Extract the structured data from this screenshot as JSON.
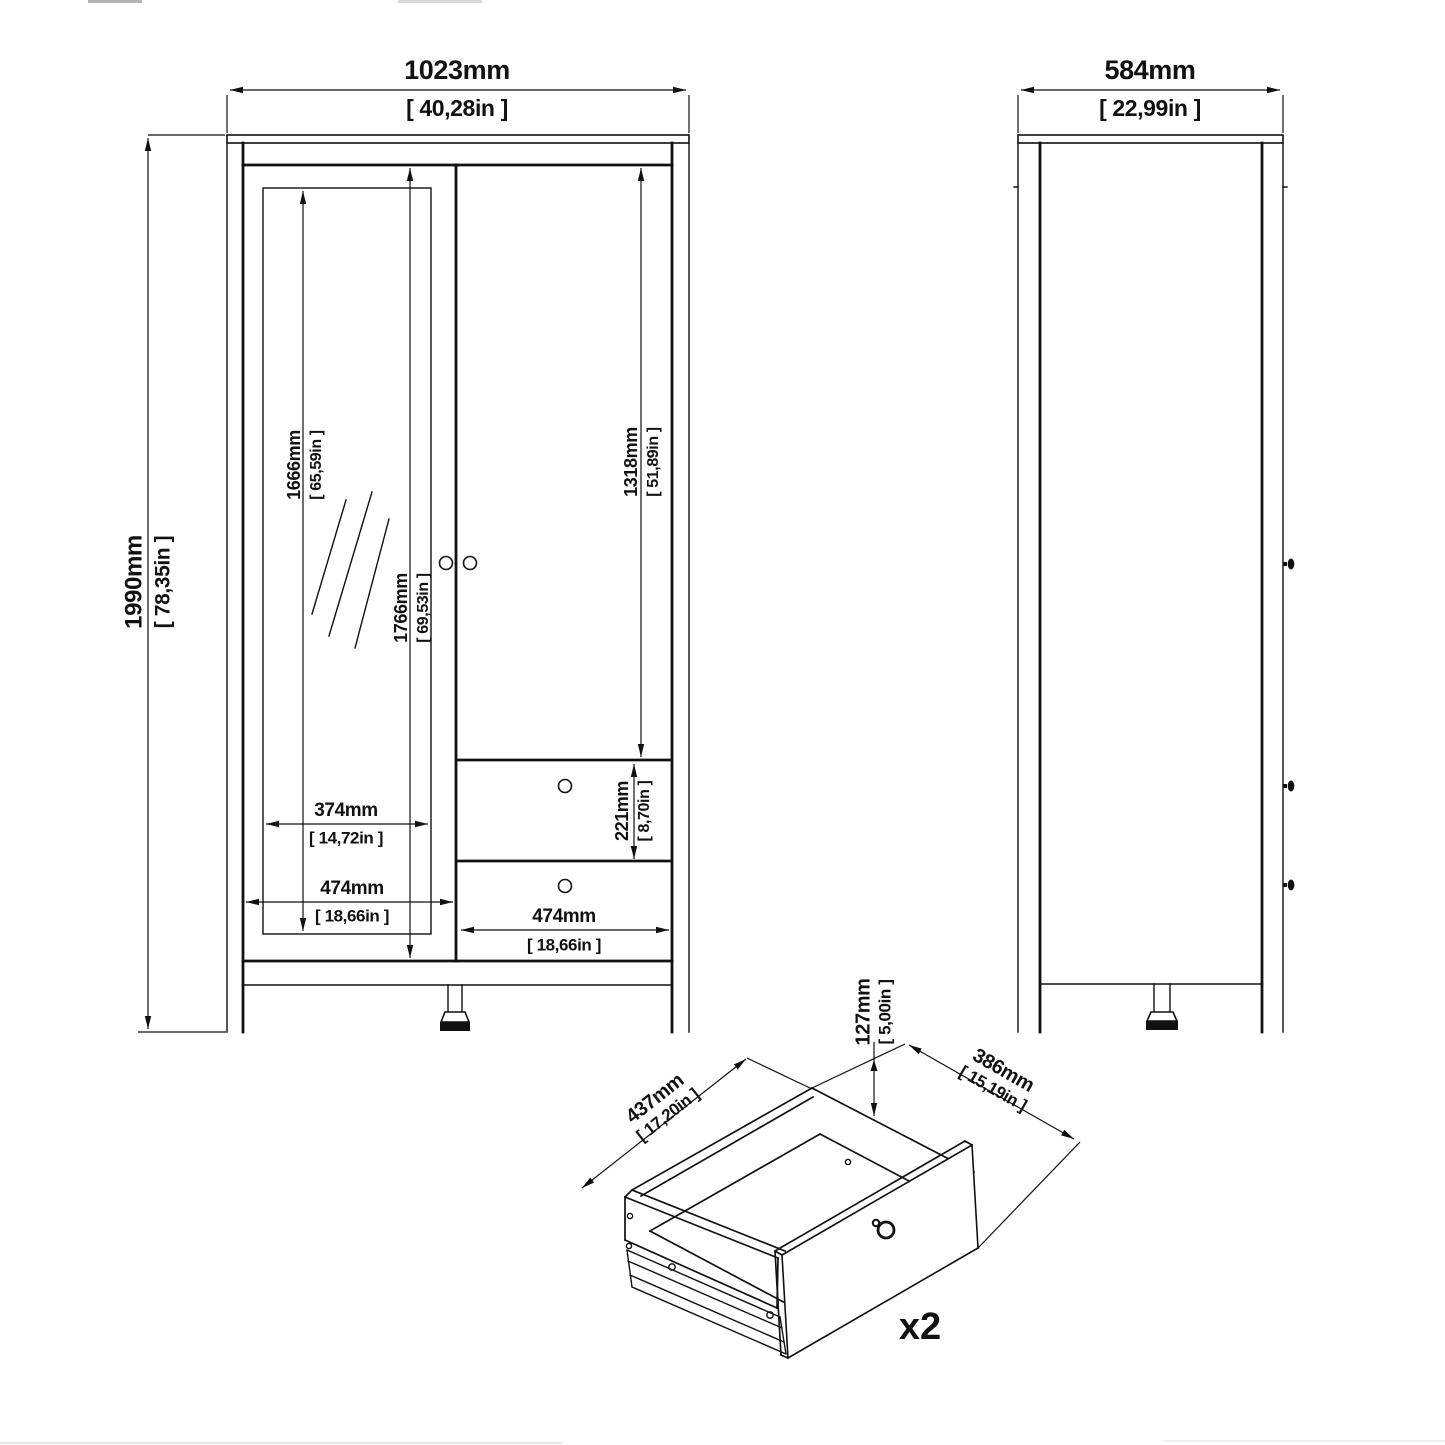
{
  "front_view": {
    "width_mm": "1023mm",
    "width_in": "[ 40,28in ]",
    "height_mm": "1990mm",
    "height_in": "[ 78,35in ]",
    "mirror_height_mm": "1666mm",
    "mirror_height_in": "[ 65,59in ]",
    "door_height_mm": "1766mm",
    "door_height_in": "[ 69,53in ]",
    "right_door_mm": "1318mm",
    "right_door_in": "[ 51,89in ]",
    "mirror_width_mm": "374mm",
    "mirror_width_in": "[ 14,72in ]",
    "door_width_mm": "474mm",
    "door_width_in": "[ 18,66in ]",
    "drawer_height_mm": "221mm",
    "drawer_height_in": "[ 8,70in ]",
    "drawer_width_mm": "474mm",
    "drawer_width_in": "[ 18,66in ]"
  },
  "side_view": {
    "depth_mm": "584mm",
    "depth_in": "[ 22,99in ]"
  },
  "drawer_detail": {
    "depth_mm": "437mm",
    "depth_in": "[ 17,20in ]",
    "width_mm": "386mm",
    "width_in": "[ 15,19in ]",
    "height_mm": "127mm",
    "height_in": "[ 5,00in ]",
    "quantity": "x2"
  },
  "colors": {
    "line": "#111111",
    "background": "#ffffff"
  }
}
